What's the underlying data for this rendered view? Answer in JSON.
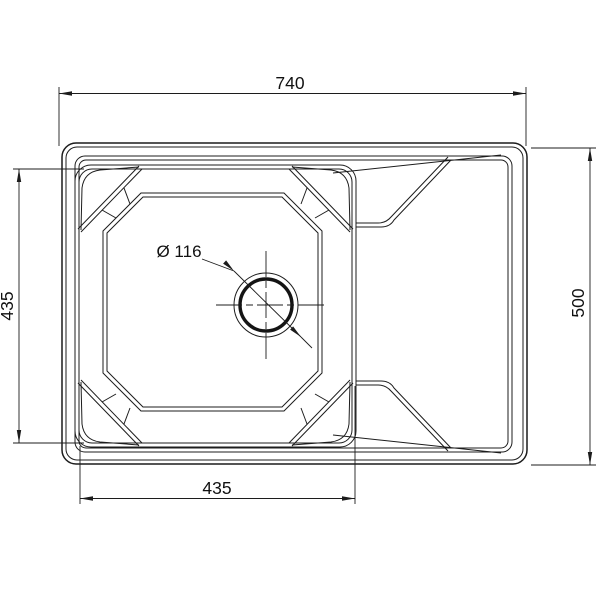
{
  "drawing": {
    "title": "sink-top-view-dimension-drawing",
    "background_color": "#ffffff",
    "line_color": "#1c1c1c",
    "dimensions": {
      "overall_width": "740",
      "overall_height": "500",
      "bowl_height_left": "435",
      "bowl_width_bottom": "435",
      "drain_diameter_label": "Ø 116"
    }
  }
}
